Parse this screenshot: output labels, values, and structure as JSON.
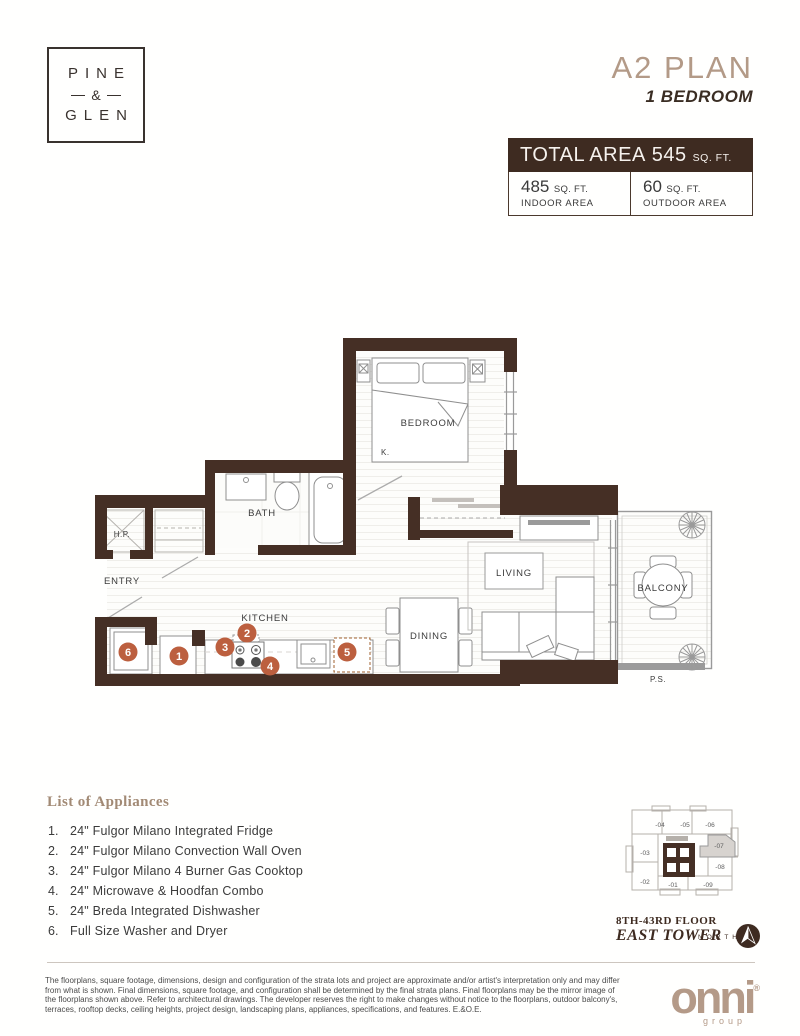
{
  "header": {
    "logo_line1": "PINE",
    "logo_amp": "&",
    "logo_line2": "GLEN",
    "plan_name": "A2 PLAN",
    "plan_type": "1 BEDROOM",
    "area": {
      "total_label": "TOTAL AREA",
      "total_value": "545",
      "total_unit": "SQ. FT.",
      "indoor_value": "485",
      "indoor_unit": "SQ. FT.",
      "indoor_label": "INDOOR AREA",
      "outdoor_value": "60",
      "outdoor_unit": "SQ. FT.",
      "outdoor_label": "OUTDOOR AREA"
    }
  },
  "floorplan": {
    "rooms": {
      "bedroom": "BEDROOM",
      "bed_size": "K.",
      "bath": "BATH",
      "hp": "H.P.",
      "entry": "ENTRY",
      "kitchen": "KITCHEN",
      "dining": "DINING",
      "living": "LIVING",
      "balcony": "BALCONY",
      "ps": "P.S."
    },
    "markers": [
      "1",
      "2",
      "3",
      "4",
      "5",
      "6"
    ]
  },
  "appliances": {
    "title": "List of Appliances",
    "items": [
      {
        "num": "1.",
        "label": "24\" Fulgor Milano Integrated Fridge"
      },
      {
        "num": "2.",
        "label": "24\" Fulgor Milano Convection Wall Oven"
      },
      {
        "num": "3.",
        "label": "24\" Fulgor Milano 4 Burner Gas Cooktop"
      },
      {
        "num": "4.",
        "label": "24\" Microwave & Hoodfan Combo"
      },
      {
        "num": "5.",
        "label": "24\" Breda Integrated Dishwasher"
      },
      {
        "num": "6.",
        "label": "Full Size Washer and Dryer"
      }
    ]
  },
  "keyplan": {
    "units": [
      "-04",
      "-05",
      "-06",
      "-03",
      "-07",
      "-08",
      "-02",
      "-01",
      "-09"
    ],
    "floor": "8TH-43RD FLOOR",
    "tower": "EAST TOWER",
    "north": "NORTH"
  },
  "footer": {
    "disclaimer": "The floorplans, square footage, dimensions, design and configuration of the strata lots and project are approximate and/or artist's interpretation only and may differ from what is shown. Final dimensions, square footage, and configuration shall be determined by the final strata plans. Final floorplans may be the mirror image of the floorplans shown above. Refer to architectural drawings. The developer reserves the right to make changes without notice to the floorplans, outdoor balcony's, terraces, rooftop decks,  ceiling heights, project design, landscaping plans, appliances, specifications, and features. E.&O.E.",
    "brand": "onni",
    "brand_reg": "®",
    "brand_sub": "group"
  },
  "colors": {
    "wall_brown": "#452f25",
    "accent_tan": "#b39a87",
    "dark_brown": "#3e2b21",
    "marker_orange": "#bc5f3f"
  }
}
